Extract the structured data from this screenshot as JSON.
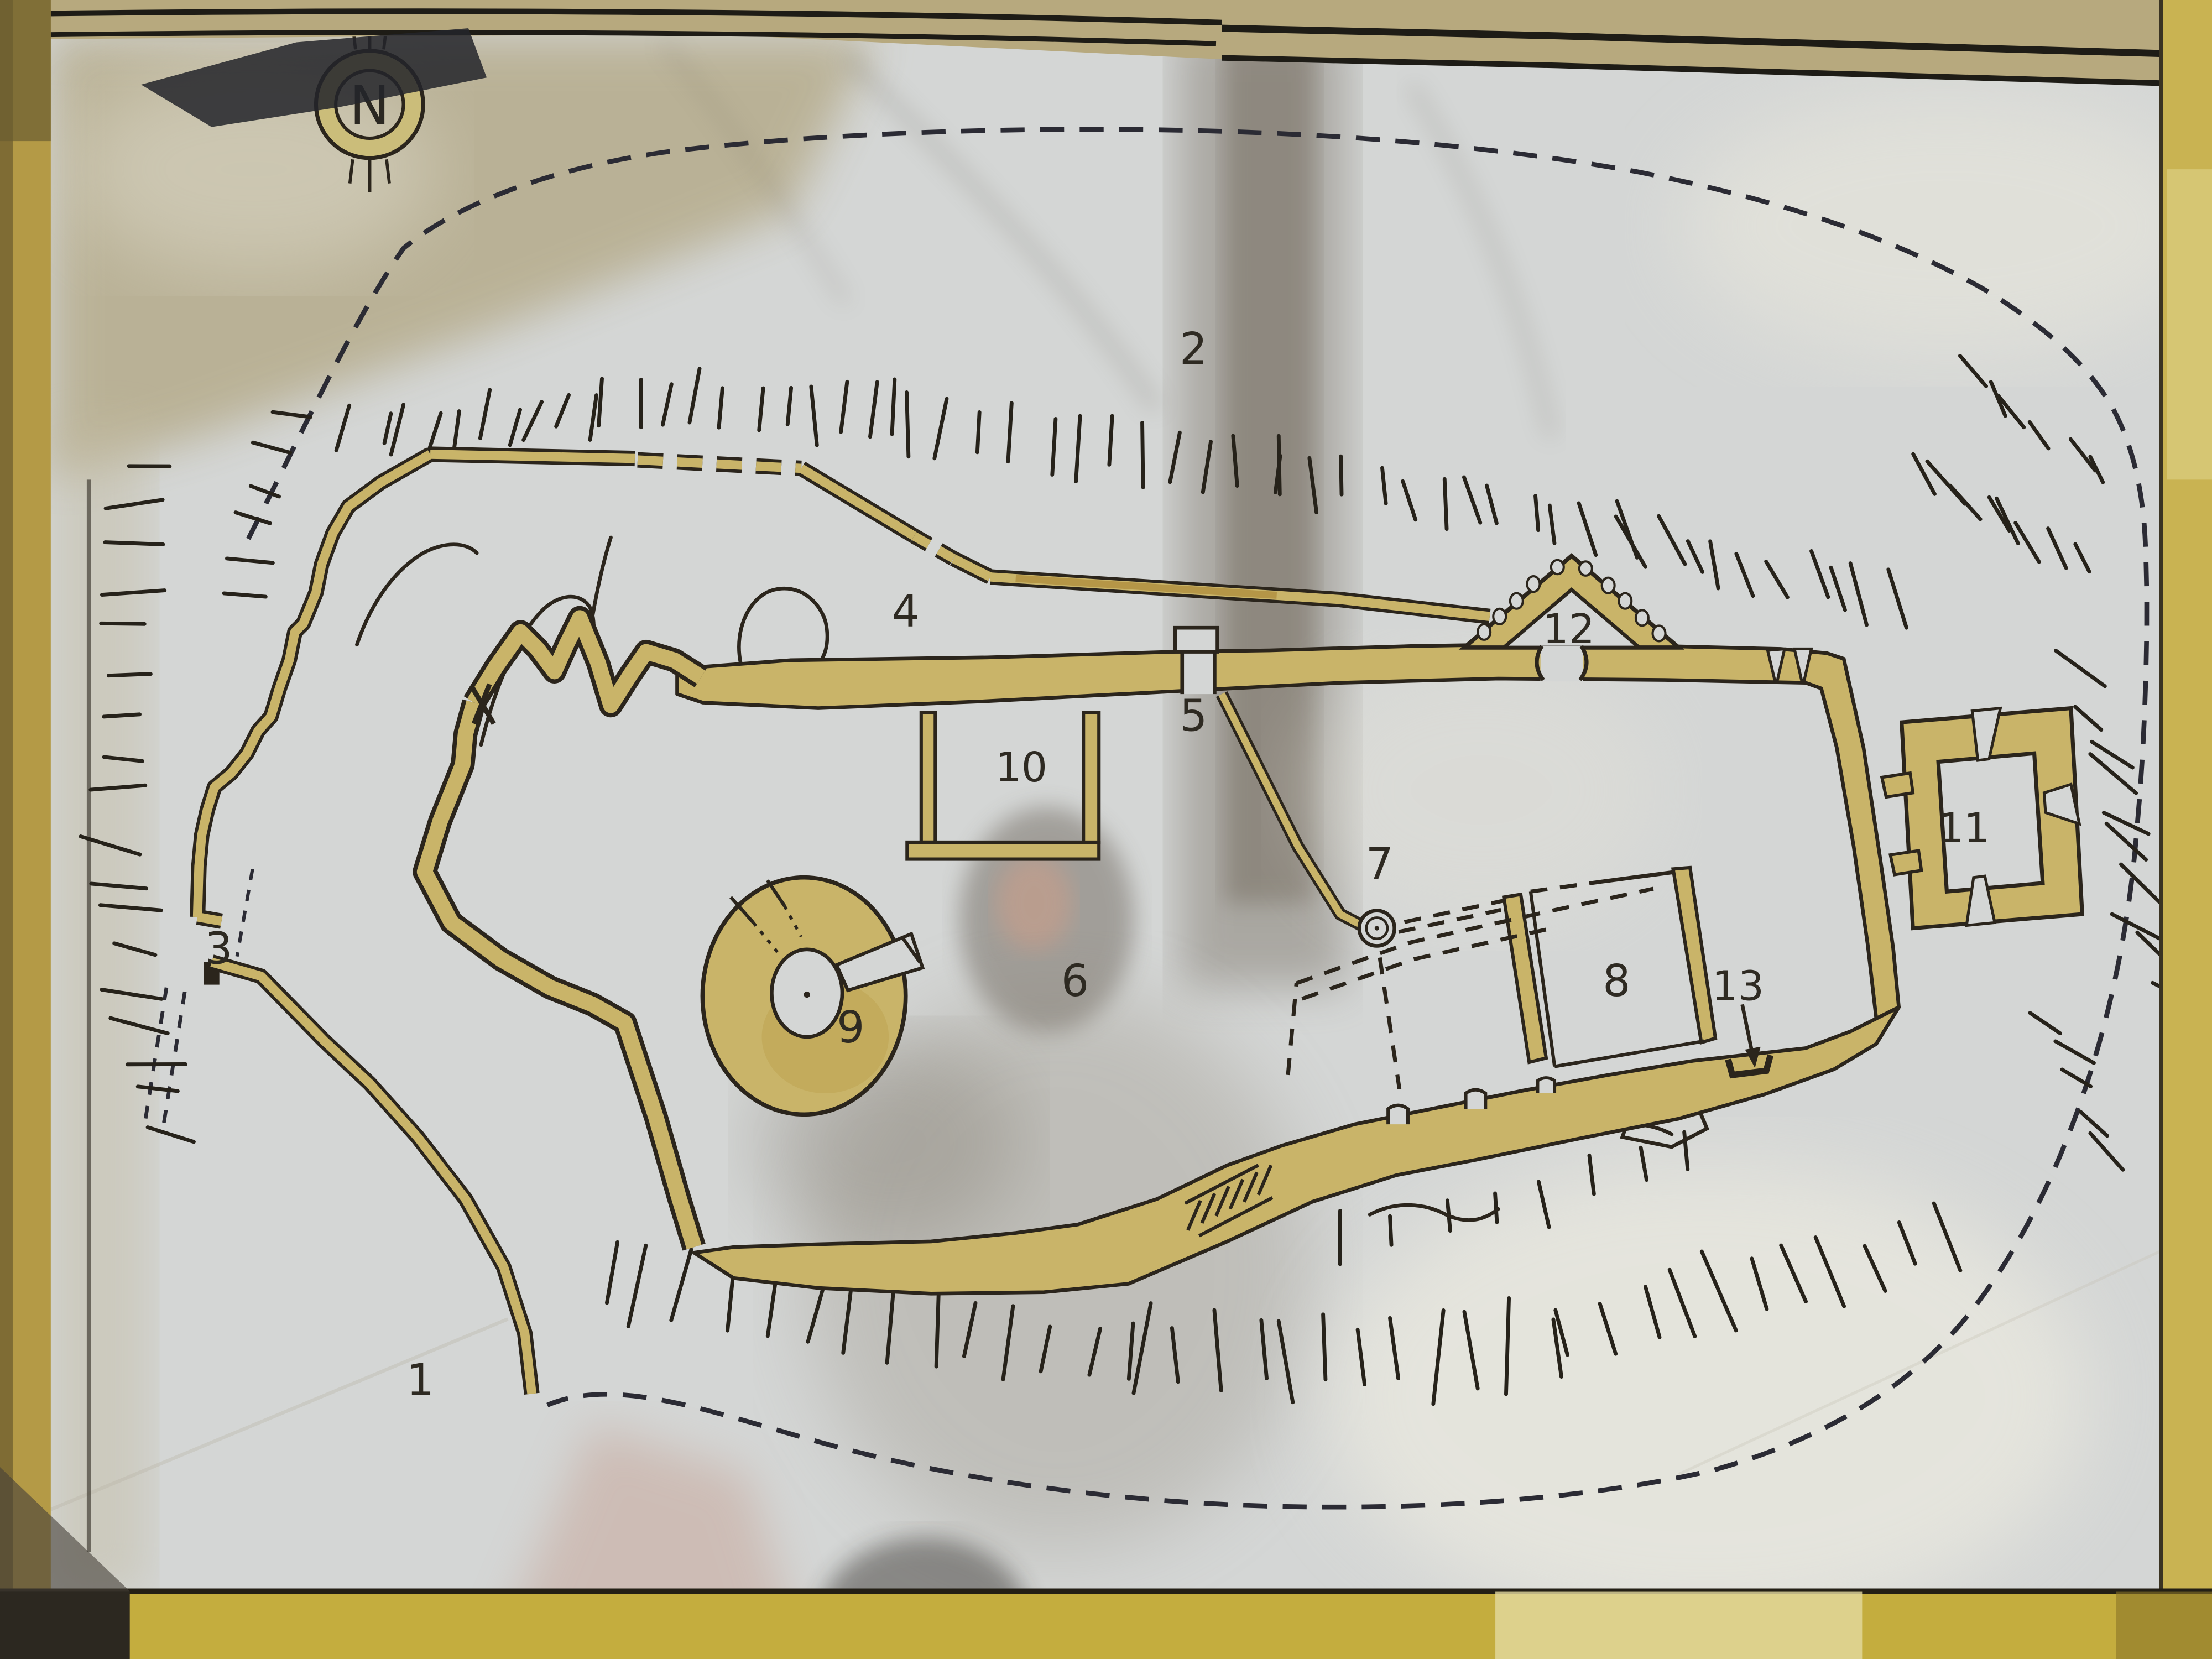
{
  "plan": {
    "compass": {
      "letter": "N"
    },
    "location_labels": [
      "1",
      "2",
      "3",
      "4",
      "5",
      "6",
      "7",
      "8",
      "9",
      "10",
      "11",
      "12",
      "13"
    ],
    "colors": {
      "paper": "#d4d6d5",
      "wall_fill": "#c9b469",
      "wall_stain": "#b59b4e",
      "ink": "#2b251c",
      "boundary_dash": "#2b2b34",
      "frame_yellow": "#c4ad3e",
      "frame_left": "#b49a46",
      "top_band_tan": "#b7a97e"
    }
  }
}
